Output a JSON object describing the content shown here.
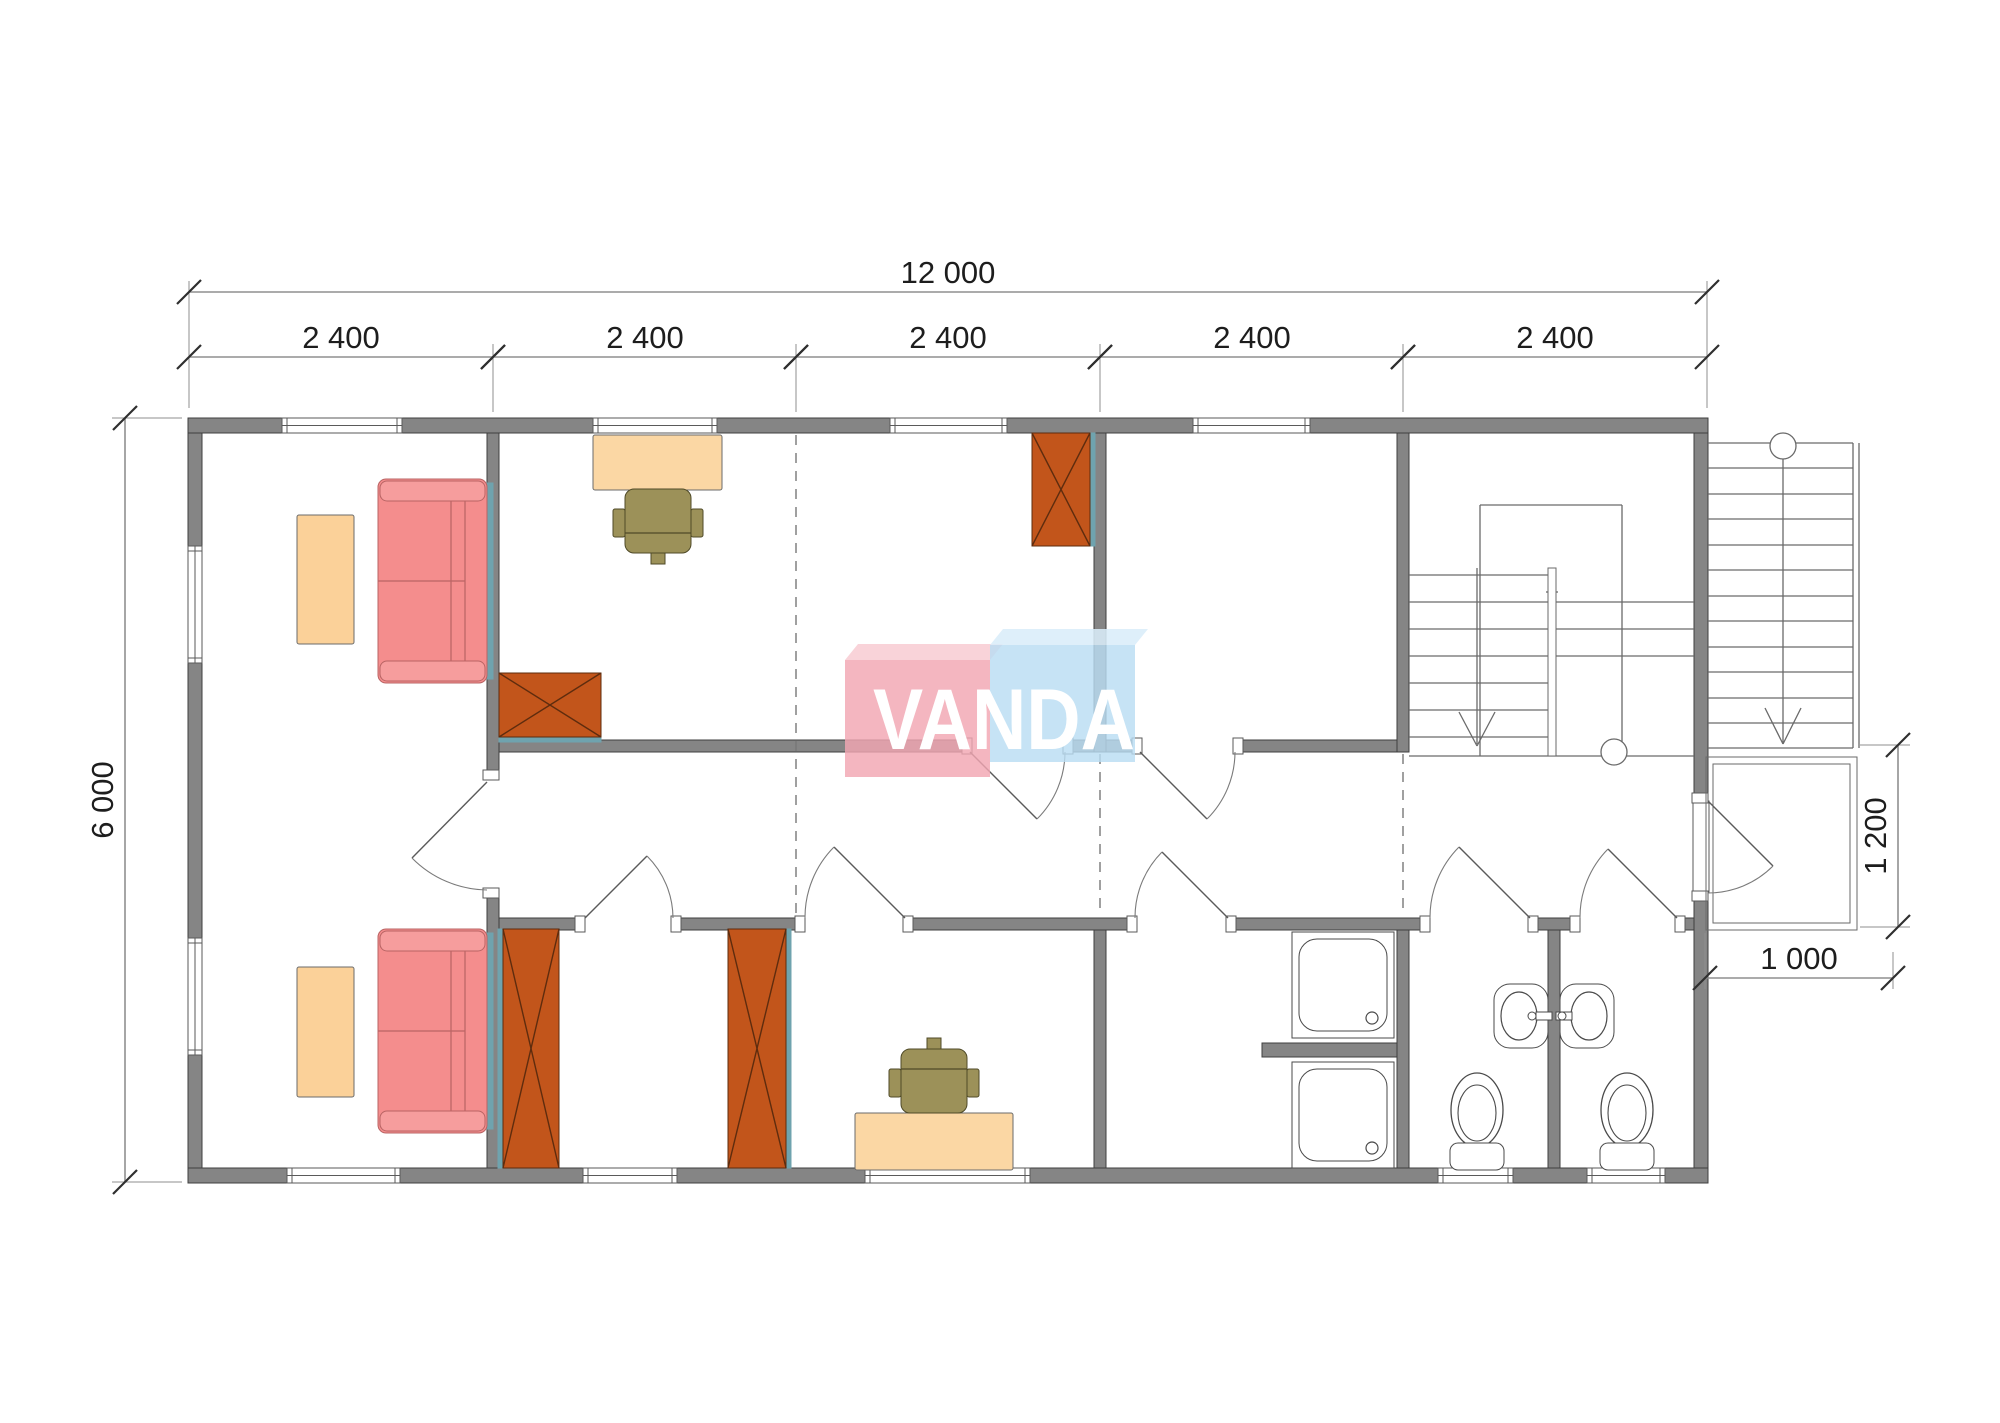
{
  "canvas": {
    "w": 2000,
    "h": 1423
  },
  "colors": {
    "wall_fill": "#858585",
    "wall_stroke": "#3f3f3f",
    "line": "#6a6a6a",
    "thin": "#8a8a8a",
    "dim_line": "#8f8f8f",
    "dim_tick": "#2f2f2f",
    "dim_text": "#1d1d1d",
    "sofa_fill": "#F48D8D",
    "sofa_band": "#F69D9D",
    "sofa_stroke": "#B96464",
    "table_fill": "#FBD199",
    "table_stroke": "#6b6b6b",
    "desk_fill": "#FBD7A4",
    "desk_stroke": "#6b6b6b",
    "wardrobe_fill": "#C2551B",
    "wardrobe_stroke": "#5e2c0e",
    "chair_fill": "#9C9159",
    "chair_stroke": "#4f4a28",
    "teal": "#6FA3AE",
    "fixture_stroke": "#4a4a4a",
    "fixture_fill": "#ffffff",
    "window_fill": "#ffffff",
    "window_stroke": "#5a5a5a"
  },
  "watermark": {
    "text": "VANDA",
    "pink_front": "845,660 990,660 990,777 845,777",
    "pink_top": "845,660 858,644 1003,644 990,660",
    "blue_front": "990,645 1135,645 1135,762 990,762",
    "blue_top": "990,645 1003,629 1148,629 1135,645",
    "pink": "rgba(242,166,178,0.82)",
    "pink_light": "rgba(248,205,212,0.88)",
    "blue": "rgba(186,221,243,0.82)",
    "blue_light": "rgba(217,237,249,0.88)",
    "text_color": "#ffffff",
    "text_x": 873,
    "text_y": 749,
    "text_length": 262,
    "font_size": 86
  },
  "walls_exterior": [
    [
      188,
      418,
      1520,
      15
    ],
    [
      188,
      1168,
      1520,
      15
    ],
    [
      188,
      433,
      14,
      735
    ],
    [
      1694,
      433,
      14,
      368
    ],
    [
      1694,
      893,
      14,
      275
    ]
  ],
  "walls_interior": [
    [
      487,
      433,
      12,
      344
    ],
    [
      487,
      890,
      12,
      278
    ],
    [
      499,
      740,
      471,
      12
    ],
    [
      1065,
      740,
      75,
      12
    ],
    [
      1242,
      740,
      155,
      12
    ],
    [
      499,
      918,
      84,
      12
    ],
    [
      673,
      918,
      132,
      12
    ],
    [
      905,
      918,
      222,
      12
    ],
    [
      1228,
      918,
      200,
      12
    ],
    [
      1528,
      918,
      50,
      12
    ],
    [
      1677,
      918,
      17,
      12
    ],
    [
      1094,
      433,
      12,
      319
    ],
    [
      1094,
      930,
      12,
      238
    ],
    [
      1397,
      433,
      12,
      319
    ],
    [
      1397,
      930,
      12,
      238
    ],
    [
      1548,
      930,
      12,
      238
    ],
    [
      1262,
      1043,
      135,
      14
    ]
  ],
  "windows": [
    {
      "x": 282,
      "y": 418,
      "w": 120,
      "h": 15,
      "o": "h"
    },
    {
      "x": 593,
      "y": 418,
      "w": 124,
      "h": 15,
      "o": "h"
    },
    {
      "x": 890,
      "y": 418,
      "w": 117,
      "h": 15,
      "o": "h"
    },
    {
      "x": 1193,
      "y": 418,
      "w": 117,
      "h": 15,
      "o": "h"
    },
    {
      "x": 188,
      "y": 546,
      "w": 14,
      "h": 117,
      "o": "v"
    },
    {
      "x": 188,
      "y": 938,
      "w": 14,
      "h": 117,
      "o": "v"
    },
    {
      "x": 287,
      "y": 1168,
      "w": 113,
      "h": 15,
      "o": "h"
    },
    {
      "x": 583,
      "y": 1168,
      "w": 94,
      "h": 15,
      "o": "h"
    },
    {
      "x": 865,
      "y": 1168,
      "w": 165,
      "h": 15,
      "o": "h"
    },
    {
      "x": 1438,
      "y": 1168,
      "w": 75,
      "h": 15,
      "o": "h"
    },
    {
      "x": 1587,
      "y": 1168,
      "w": 78,
      "h": 15,
      "o": "h"
    }
  ],
  "jamb_caps": [
    [
      483,
      770,
      16,
      10
    ],
    [
      483,
      888,
      16,
      10
    ],
    [
      962,
      738,
      10,
      16
    ],
    [
      1063,
      738,
      10,
      16
    ],
    [
      1132,
      738,
      10,
      16
    ],
    [
      1233,
      738,
      10,
      16
    ],
    [
      575,
      916,
      10,
      16
    ],
    [
      671,
      916,
      10,
      16
    ],
    [
      795,
      916,
      10,
      16
    ],
    [
      903,
      916,
      10,
      16
    ],
    [
      1127,
      916,
      10,
      16
    ],
    [
      1226,
      916,
      10,
      16
    ],
    [
      1420,
      916,
      10,
      16
    ],
    [
      1528,
      916,
      10,
      16
    ],
    [
      1570,
      916,
      10,
      16
    ],
    [
      1675,
      916,
      10,
      16
    ],
    [
      1693,
      801,
      16,
      92
    ],
    [
      1692,
      793,
      16,
      10
    ],
    [
      1692,
      891,
      16,
      10
    ]
  ],
  "doors": [
    {
      "name": "door-living-room",
      "px": 487,
      "py": 782,
      "tx": 412,
      "ty": 858,
      "ex": 487,
      "ey": 890,
      "r": 107,
      "sweep": 0
    },
    {
      "name": "door-office-room",
      "px": 970,
      "py": 752,
      "tx": 1037,
      "ty": 819,
      "ex": 1065,
      "ey": 752,
      "r": 95,
      "sweep": 0
    },
    {
      "name": "door-bedroom",
      "px": 1140,
      "py": 752,
      "tx": 1207,
      "ty": 819,
      "ex": 1235,
      "ey": 752,
      "r": 95,
      "sweep": 0
    },
    {
      "name": "door-storage-a",
      "px": 585,
      "py": 918,
      "tx": 647,
      "ty": 856,
      "ex": 673,
      "ey": 918,
      "r": 88,
      "sweep": 1
    },
    {
      "name": "door-storage-b",
      "px": 905,
      "py": 918,
      "tx": 834,
      "ty": 847,
      "ex": 805,
      "ey": 918,
      "r": 100,
      "sweep": 0
    },
    {
      "name": "door-shower-room",
      "px": 1228,
      "py": 918,
      "tx": 1162,
      "ty": 852,
      "ex": 1135,
      "ey": 918,
      "r": 93,
      "sweep": 0
    },
    {
      "name": "door-wc-left",
      "px": 1530,
      "py": 918,
      "tx": 1459,
      "ty": 847,
      "ex": 1430,
      "ey": 918,
      "r": 100,
      "sweep": 0
    },
    {
      "name": "door-wc-right",
      "px": 1677,
      "py": 918,
      "tx": 1608,
      "ty": 849,
      "ex": 1580,
      "ey": 918,
      "r": 97,
      "sweep": 0
    },
    {
      "name": "door-entrance",
      "px": 1708,
      "py": 801,
      "tx": 1773,
      "ty": 866,
      "ex": 1708,
      "ey": 893,
      "r": 92,
      "sweep": 1
    }
  ],
  "dashed_lines": [
    [
      796,
      435,
      796,
      916
    ],
    [
      1100,
      754,
      1100,
      916
    ],
    [
      1403,
      754,
      1403,
      916
    ]
  ],
  "stair_lines": [
    [
      1409,
      575,
      1548,
      575
    ],
    [
      1409,
      602,
      1548,
      602
    ],
    [
      1409,
      629,
      1548,
      629
    ],
    [
      1409,
      656,
      1548,
      656
    ],
    [
      1409,
      683,
      1548,
      683
    ],
    [
      1409,
      710,
      1548,
      710
    ],
    [
      1409,
      737,
      1548,
      737
    ],
    [
      1556,
      602,
      1694,
      602
    ],
    [
      1556,
      629,
      1694,
      629
    ],
    [
      1556,
      656,
      1694,
      656
    ],
    [
      1409,
      756,
      1694,
      756
    ],
    [
      1480,
      505,
      1622,
      505
    ],
    [
      1480,
      505,
      1480,
      756
    ],
    [
      1622,
      505,
      1622,
      756
    ],
    [
      1546,
      592,
      1558,
      592
    ],
    [
      1477,
      568,
      1477,
      744
    ],
    [
      1459,
      712,
      1477,
      746
    ],
    [
      1495,
      712,
      1477,
      746
    ],
    [
      1708,
      443,
      1853,
      443
    ],
    [
      1708,
      468,
      1853,
      468
    ],
    [
      1708,
      494,
      1853,
      494
    ],
    [
      1708,
      519,
      1853,
      519
    ],
    [
      1708,
      545,
      1853,
      545
    ],
    [
      1708,
      570,
      1853,
      570
    ],
    [
      1708,
      596,
      1853,
      596
    ],
    [
      1708,
      621,
      1853,
      621
    ],
    [
      1708,
      647,
      1853,
      647
    ],
    [
      1708,
      672,
      1853,
      672
    ],
    [
      1708,
      698,
      1853,
      698
    ],
    [
      1708,
      723,
      1853,
      723
    ],
    [
      1708,
      748,
      1853,
      748
    ],
    [
      1853,
      443,
      1853,
      748
    ],
    [
      1859,
      443,
      1859,
      748
    ],
    [
      1783,
      459,
      1783,
      744
    ],
    [
      1765,
      708,
      1783,
      744
    ],
    [
      1801,
      708,
      1783,
      744
    ]
  ],
  "outline_rects": [
    [
      1706,
      757,
      151,
      173
    ],
    [
      1713,
      764,
      137,
      159
    ]
  ],
  "white_rects": [
    [
      1548,
      568,
      8,
      188
    ]
  ],
  "circles": [
    [
      1614,
      752,
      13
    ],
    [
      1783,
      446,
      13
    ]
  ],
  "thin_lines": [
    [
      189,
      408,
      189,
      281
    ],
    [
      1707,
      408,
      1707,
      281
    ],
    [
      493,
      412,
      493,
      344
    ],
    [
      796,
      412,
      796,
      344
    ],
    [
      1100,
      412,
      1100,
      344
    ],
    [
      1403,
      412,
      1403,
      344
    ],
    [
      182,
      418,
      112,
      418
    ],
    [
      182,
      1182,
      112,
      1182
    ],
    [
      1860,
      745,
      1910,
      745
    ],
    [
      1860,
      927,
      1910,
      927
    ],
    [
      1705,
      933,
      1705,
      989
    ],
    [
      1893,
      952,
      1893,
      989
    ]
  ],
  "dimensions": [
    {
      "label": "12 000",
      "x1": 189,
      "y1": 292,
      "x2": 1707,
      "y2": 292,
      "lx": 948,
      "ly": 283,
      "rot": 0
    },
    {
      "label": "2 400",
      "x1": 189,
      "y1": 357,
      "x2": 493,
      "y2": 357,
      "lx": 341,
      "ly": 348,
      "rot": 0
    },
    {
      "label": "2 400",
      "x1": 493,
      "y1": 357,
      "x2": 796,
      "y2": 357,
      "lx": 645,
      "ly": 348,
      "rot": 0
    },
    {
      "label": "2 400",
      "x1": 796,
      "y1": 357,
      "x2": 1100,
      "y2": 357,
      "lx": 948,
      "ly": 348,
      "rot": 0
    },
    {
      "label": "2 400",
      "x1": 1100,
      "y1": 357,
      "x2": 1403,
      "y2": 357,
      "lx": 1252,
      "ly": 348,
      "rot": 0
    },
    {
      "label": "2 400",
      "x1": 1403,
      "y1": 357,
      "x2": 1707,
      "y2": 357,
      "lx": 1555,
      "ly": 348,
      "rot": 0
    },
    {
      "label": "6 000",
      "x1": 125,
      "y1": 418,
      "x2": 125,
      "y2": 1182,
      "lx": 113,
      "ly": 800,
      "rot": -90
    },
    {
      "label": "1 200",
      "x1": 1898,
      "y1": 745,
      "x2": 1898,
      "y2": 927,
      "lx": 1886,
      "ly": 836,
      "rot": -90
    },
    {
      "label": "1 000",
      "x1": 1705,
      "y1": 978,
      "x2": 1893,
      "y2": 978,
      "lx": 1799,
      "ly": 969,
      "rot": 0
    }
  ],
  "sofas": [
    {
      "x": 378,
      "y": 479,
      "w": 109,
      "h": 204
    },
    {
      "x": 378,
      "y": 929,
      "w": 109,
      "h": 204
    }
  ],
  "tables": [
    [
      297,
      515,
      57,
      129
    ],
    [
      297,
      967,
      57,
      130
    ]
  ],
  "desks": [
    [
      593,
      435,
      129,
      55
    ],
    [
      855,
      1113,
      158,
      57
    ]
  ],
  "chairs": [
    {
      "cx": 658,
      "cy": 521,
      "back": "bottom"
    },
    {
      "cx": 934,
      "cy": 1081,
      "back": "top"
    }
  ],
  "wardrobes": [
    {
      "x": 499,
      "y": 673,
      "w": 102,
      "h": 64,
      "wall": "bottom"
    },
    {
      "x": 1032,
      "y": 433,
      "w": 58,
      "h": 113,
      "wall": "right"
    },
    {
      "x": 503,
      "y": 929,
      "w": 56,
      "h": 239,
      "wall": "left"
    },
    {
      "x": 728,
      "y": 929,
      "w": 58,
      "h": 239,
      "wall": "right"
    }
  ],
  "showers": [
    [
      1292,
      932,
      102,
      106
    ],
    [
      1292,
      1062,
      102,
      106
    ]
  ],
  "sinks": [
    {
      "x": 1494,
      "y": 984,
      "w": 54,
      "h": 64,
      "side": "left"
    },
    {
      "x": 1560,
      "y": 984,
      "w": 54,
      "h": 64,
      "side": "right"
    }
  ],
  "toilets": [
    {
      "cx": 1477
    },
    {
      "cx": 1627
    }
  ]
}
